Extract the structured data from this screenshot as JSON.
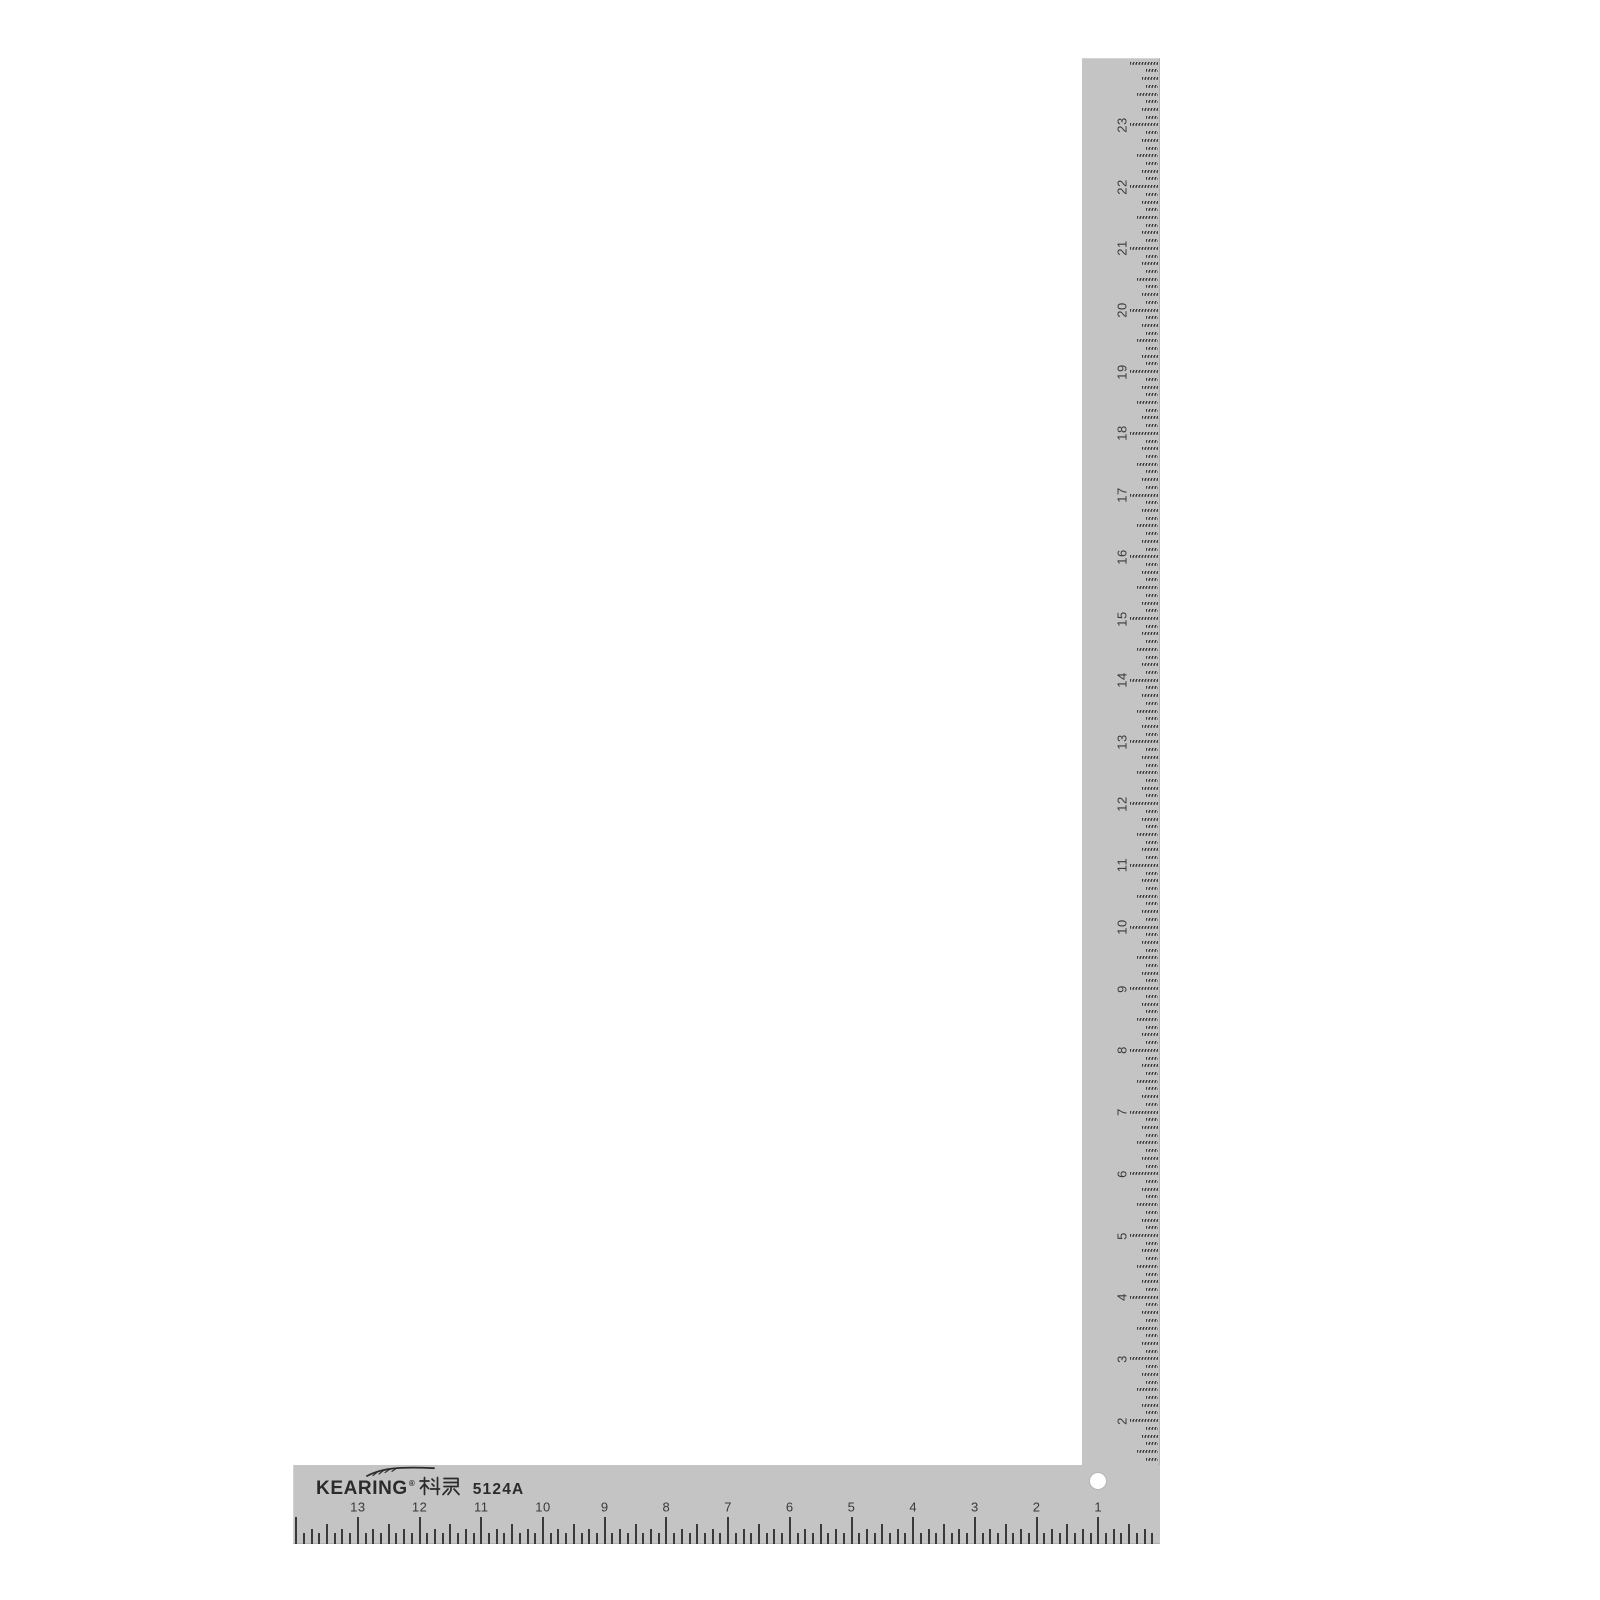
{
  "product": {
    "brand": "KEARING",
    "registered_mark": "®",
    "brand_cjk": "科灵",
    "model": "5124A"
  },
  "ruler": {
    "type": "l-square",
    "divisions_per_inch": 8,
    "horizontal_scale": {
      "direction": "right-to-left",
      "numbers": [
        "1",
        "2",
        "3",
        "4",
        "5",
        "6",
        "7",
        "8",
        "9",
        "10",
        "11",
        "12",
        "13"
      ]
    },
    "vertical_scale": {
      "direction": "bottom-to-top",
      "numbers": [
        "1",
        "2",
        "3",
        "4",
        "5",
        "6",
        "7",
        "8",
        "9",
        "10",
        "11",
        "12",
        "13",
        "14",
        "15",
        "16",
        "17",
        "18",
        "19",
        "20",
        "21",
        "22",
        "23"
      ]
    }
  },
  "colors": {
    "body": "#c4c4c4",
    "marks": "#3a3a3a",
    "background": "#ffffff",
    "hole": "#ffffff"
  }
}
